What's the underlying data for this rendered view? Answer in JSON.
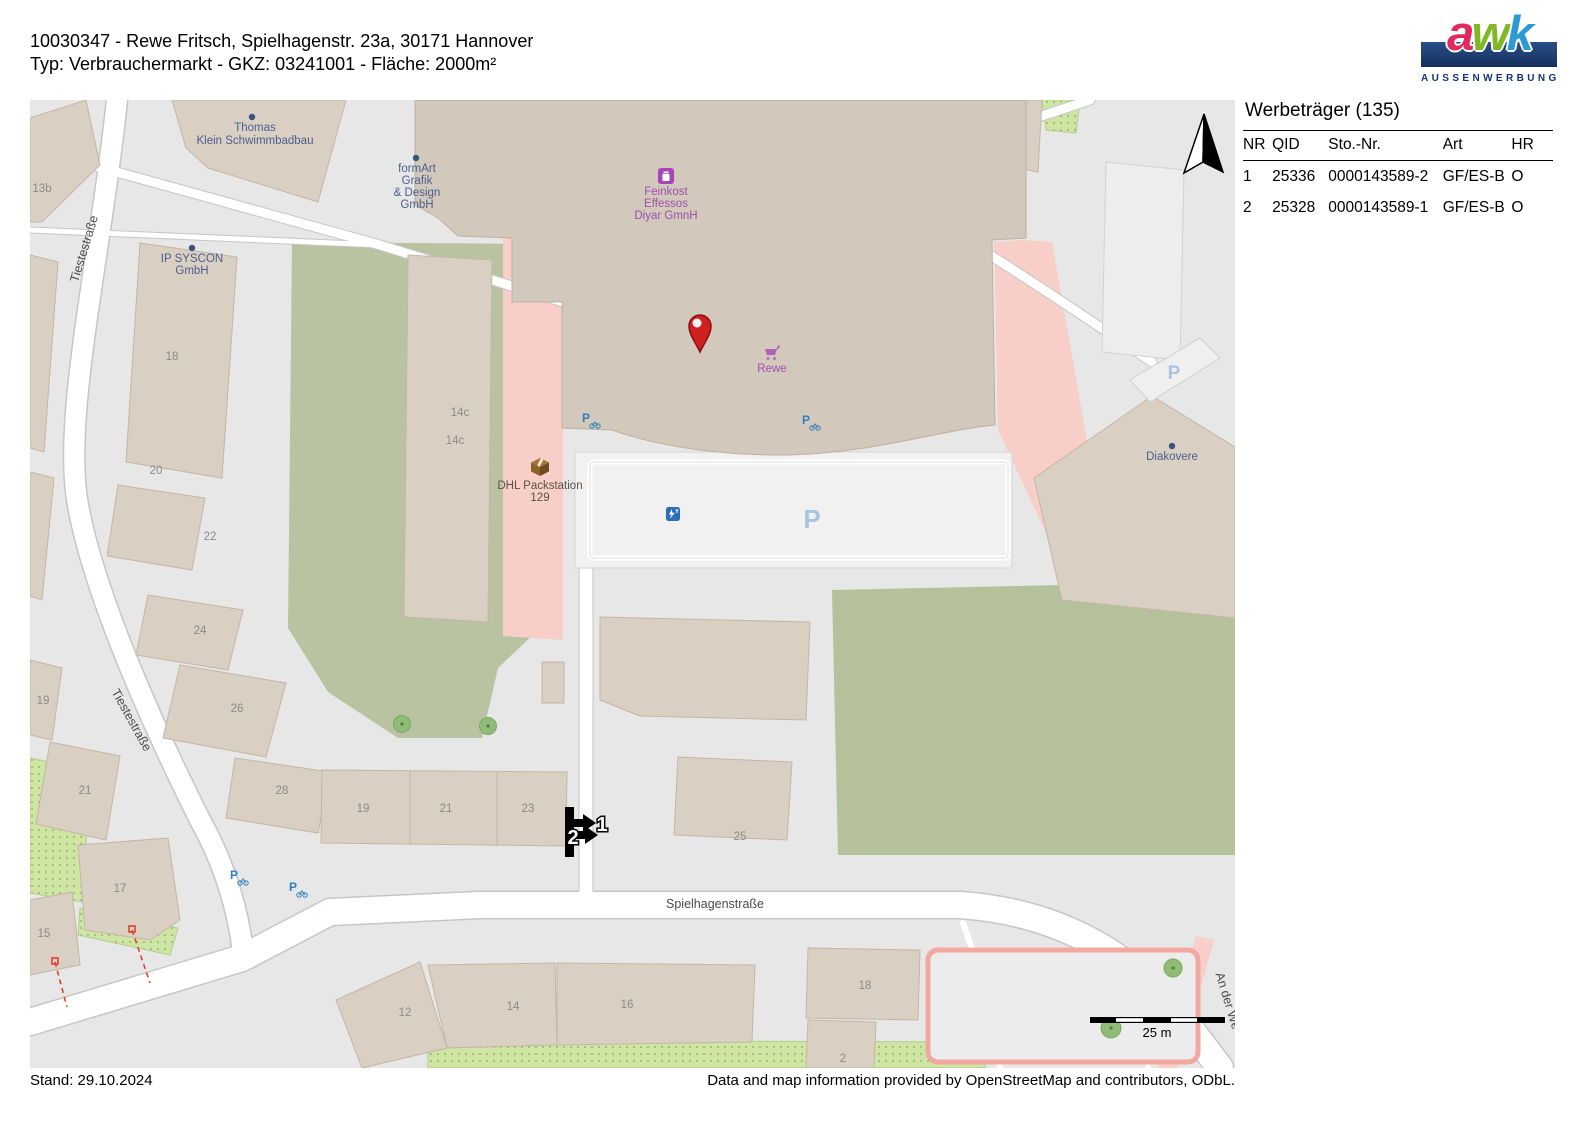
{
  "header": {
    "line1": "10030347 - Rewe Fritsch, Spielhagenstr. 23a, 30171 Hannover",
    "line2": "Typ: Verbrauchermarkt - GKZ: 03241001 - Fläche: 2000m²"
  },
  "logo": {
    "letters": [
      {
        "char": "a",
        "color": "#e02a5e"
      },
      {
        "char": "w",
        "color": "#80b826"
      },
      {
        "char": "k",
        "color": "#2d9ad4"
      }
    ],
    "subtitle": "AUSSENWERBUNG",
    "bar_color": "#16305f"
  },
  "panel": {
    "title": "Werbeträger (135)",
    "columns": [
      "NR",
      "QID",
      "Sto.-Nr.",
      "Art",
      "HR"
    ],
    "rows": [
      {
        "nr": "1",
        "qid": "25336",
        "sto_nr": "0000143589-2",
        "art": "GF/ES-B",
        "hr": "O"
      },
      {
        "nr": "2",
        "qid": "25328",
        "sto_nr": "0000143589-1",
        "art": "GF/ES-B",
        "hr": "O"
      }
    ]
  },
  "map": {
    "street_labels": [
      "Tiestestraße",
      "Tiestestraße",
      "Spielhagenstraße",
      "An der We"
    ],
    "pois": {
      "thomas": {
        "lines": [
          "Thomas",
          "Klein Schwimmbadbau"
        ]
      },
      "formart": {
        "lines": [
          "formArt",
          "Grafik",
          "& Design",
          "GmbH"
        ]
      },
      "feinkost": {
        "lines": [
          "Feinkost",
          "Effessos",
          "Diyar GmnH"
        ]
      },
      "ipsyscon": {
        "lines": [
          "IP SYSCON",
          "GmbH"
        ]
      },
      "dhl": {
        "lines": [
          "DHL Packstation",
          "129"
        ]
      },
      "rewe": {
        "label": "Rewe"
      },
      "diakovere": {
        "label": "Diakovere"
      }
    },
    "house_numbers": [
      "13b",
      "18",
      "20",
      "22",
      "24",
      "26",
      "19",
      "21",
      "28",
      "17",
      "15",
      "19",
      "21",
      "23",
      "25",
      "12",
      "14",
      "16",
      "18",
      "2",
      "14c",
      "14c"
    ],
    "parking_letters": [
      "P",
      "P"
    ],
    "markers": [
      "1",
      "2"
    ],
    "scale_label": "25 m",
    "colors": {
      "building": "#d9cfc3",
      "retail_pink": "#f7cfc8",
      "green": "#b5c19b",
      "allotment_green": "#cfe5a4",
      "pin_red": "#cf2020",
      "poi_blue": "#4d5f8e",
      "poi_purple": "#a04fae",
      "transport_blue": "#2f7fc1"
    }
  },
  "footer": {
    "stand": "Stand: 29.10.2024",
    "attribution": "Data and map information provided by OpenStreetMap and contributors, ODbL."
  }
}
